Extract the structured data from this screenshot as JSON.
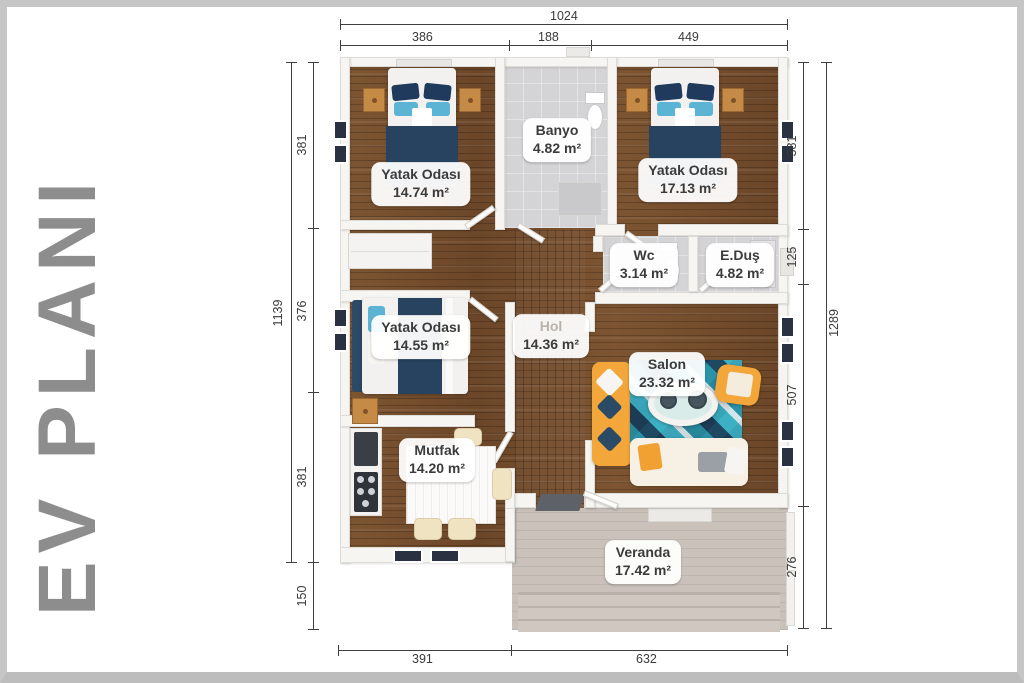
{
  "title": "EV PLANI",
  "rooms": [
    {
      "name": "Yatak Odası",
      "area": "14.74 m²"
    },
    {
      "name": "Banyo",
      "area": "4.82 m²"
    },
    {
      "name": "Yatak Odası",
      "area": "17.13 m²"
    },
    {
      "name": "Wc",
      "area": "3.14 m²"
    },
    {
      "name": "E.Duş",
      "area": "4.82 m²"
    },
    {
      "name": "Yatak Odası",
      "area": "14.55 m²"
    },
    {
      "name": "Hol",
      "area": "14.36 m²"
    },
    {
      "name": "Salon",
      "area": "23.32 m²"
    },
    {
      "name": "Mutfak",
      "area": "14.20 m²"
    },
    {
      "name": "Veranda",
      "area": "17.42 m²"
    }
  ],
  "dims": {
    "top": {
      "total": "1024",
      "segments": [
        "386",
        "188",
        "449"
      ]
    },
    "left": {
      "total": "1139",
      "segments": [
        "381",
        "376",
        "381",
        "150"
      ]
    },
    "right": {
      "total": "1289",
      "segments": [
        "381",
        "125",
        "507",
        "276"
      ]
    },
    "bottom": {
      "segments": [
        "391",
        "632"
      ]
    }
  },
  "colors": {
    "title_gray": "#8d8d8d",
    "wood_floor": "#7a5231",
    "tile_floor": "#d4d3d5",
    "wall": "#f6f5f2",
    "window_dark": "#2a3140",
    "bed_blanket": "#27435f",
    "pillow_blue": "#5bb4d4",
    "nightstand_wood": "#c58a45",
    "sofa_yellow": "#f3a73b",
    "rug_teal": "#2b93a8",
    "rug_navy": "#1d3c55",
    "veranda_floor": "#c9c1ba",
    "dimension_line": "#3f3f3f"
  }
}
